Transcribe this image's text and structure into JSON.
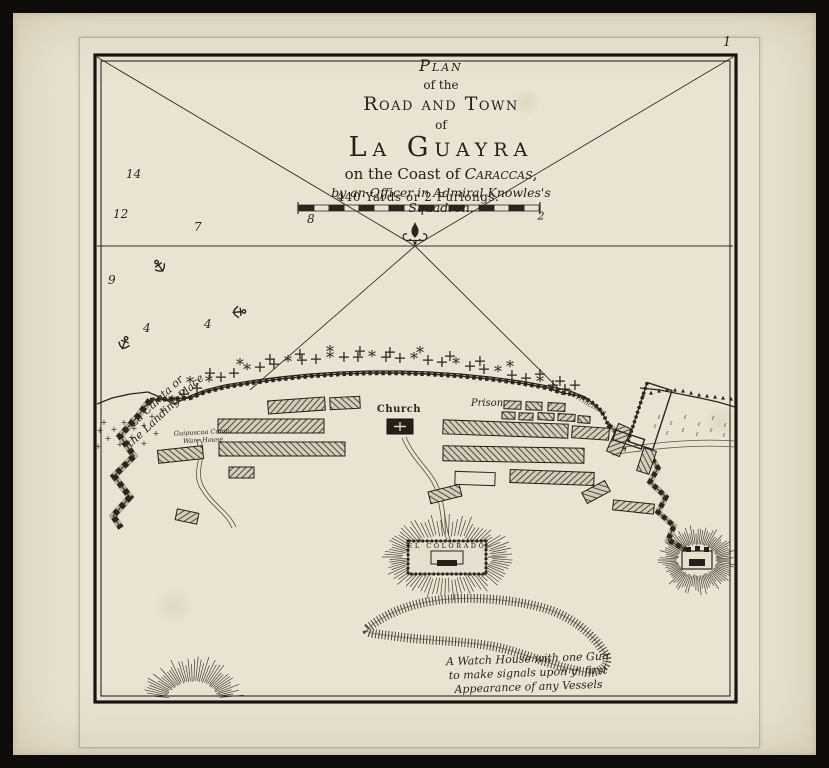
{
  "plate": {
    "number": "1"
  },
  "title": {
    "plan": "Plan",
    "of_the": "of the",
    "road_and_town": "Road and Town",
    "of": "of",
    "la_guayra": "La Guayra",
    "coast_pre": "on the Coast of ",
    "coast_name": "Caraccas",
    "coast_post": ",",
    "byline": "by an Officer in Admiral Knowles's Squadron."
  },
  "scale": {
    "label": "440 Yards or 2 Furlongs.",
    "right_mark": "2"
  },
  "labels": {
    "landing_place": "La Caleta or\nthe Landing Place",
    "warehouse": "Guipuscoa Comp.\nWare House",
    "church": "Church",
    "prison": "Prison",
    "trench": "la Trinchera",
    "fort": "EL COLORADO",
    "watch_house": "A Watch House with one Gun\nto make signals upon yᵉ first\nAppearance of any Vessels"
  },
  "colors": {
    "paper": "#e8e3d2",
    "ink": "#2b261d",
    "ink_light": "#4a4437",
    "wall_fill": "#b5ae9a",
    "border": "#141210"
  },
  "soundings": [
    {
      "v": "14",
      "x": 126,
      "y": 178
    },
    {
      "v": "12",
      "x": 113,
      "y": 218
    },
    {
      "v": "7",
      "x": 194,
      "y": 231
    },
    {
      "v": "8",
      "x": 307,
      "y": 223
    },
    {
      "v": "9",
      "x": 108,
      "y": 284
    },
    {
      "v": "4",
      "x": 143,
      "y": 332
    },
    {
      "v": "4",
      "x": 204,
      "y": 328
    }
  ],
  "anchors": [
    {
      "x": 160,
      "y": 267,
      "rot": -35
    },
    {
      "x": 238,
      "y": 312,
      "rot": 85
    },
    {
      "x": 124,
      "y": 344,
      "rot": 20
    }
  ],
  "map_data": {
    "frame_outer": [
      95,
      55,
      641,
      647
    ],
    "frame_inner": [
      101,
      61,
      629,
      635
    ],
    "compass_center": [
      415,
      246
    ],
    "bearing_lines": [
      [
        415,
        246,
        97,
        57
      ],
      [
        415,
        246,
        733,
        57
      ],
      [
        97,
        246,
        733,
        246
      ],
      [
        415,
        246,
        250,
        390
      ],
      [
        415,
        246,
        560,
        390
      ]
    ],
    "scale_bar": {
      "x": 299,
      "y": 205,
      "w": 240,
      "h": 6,
      "segments": 16
    },
    "shore_west": "97,404 112,398 130,394 148,392 162,398 174,404 190,396 205,390 225,385 250,381 280,377 310,374 340,372 370,371 400,371 430,372 460,374 490,377 520,381 548,386 570,391 585,397 596,406 604,416",
    "sea_wall": "150,400 190,398 205,392 225,387 250,383 280,379 310,376 340,374 370,373 400,373 430,374 460,376 490,379 520,383 548,388 563,393",
    "trench_arc": "M563,393 Q590,396 601,411 Q606,419 608,425",
    "west_wall": "150,400 138,416 120,436 134,456 114,476 130,497 113,516 121,528",
    "east_wall": "608,425 618,433 612,445 626,449",
    "east_wall2": "648,452 658,468 650,482 666,497 658,512 674,526 668,540 686,550",
    "east_coast": "640,388 660,390 680,394 700,398 718,402 735,407",
    "roads": [
      "M402,438 C412,462 430,472 436,492 C442,512 440,524 447,540",
      "M406,437 C416,461 434,471 440,491 C446,511 444,523 450,539",
      "M196,440 C205,458 190,470 200,488 C210,506 225,512 232,528",
      "M200,439 C209,457 194,469 204,487 C214,505 229,511 236,527",
      "M612,449 C650,443 695,438 735,441",
      "M612,455 C650,449 695,444 735,447"
    ],
    "buildings": [
      [
        268,
        399,
        57,
        13,
        -4
      ],
      [
        330,
        397,
        30,
        12,
        -3
      ],
      [
        218,
        419,
        106,
        14,
        0
      ],
      [
        219,
        442,
        126,
        14,
        0
      ],
      [
        229,
        467,
        25,
        11,
        0
      ],
      [
        158,
        448,
        45,
        13,
        -6
      ],
      [
        176,
        511,
        22,
        11,
        12
      ],
      [
        443,
        422,
        125,
        14,
        2
      ],
      [
        572,
        427,
        37,
        12,
        4
      ],
      [
        443,
        447,
        141,
        15,
        1
      ],
      [
        510,
        471,
        84,
        13,
        2
      ],
      [
        583,
        486,
        26,
        12,
        -28
      ],
      [
        613,
        502,
        41,
        10,
        6
      ],
      [
        429,
        488,
        32,
        12,
        -14
      ],
      [
        504,
        401,
        17,
        8,
        2
      ],
      [
        526,
        402,
        16,
        8,
        2
      ],
      [
        548,
        403,
        17,
        8,
        3
      ],
      [
        502,
        412,
        13,
        7,
        2
      ],
      [
        519,
        413,
        14,
        7,
        2
      ],
      [
        538,
        413,
        16,
        7,
        3
      ],
      [
        558,
        414,
        17,
        7,
        3
      ],
      [
        578,
        416,
        12,
        7,
        4
      ],
      [
        612,
        425,
        14,
        30,
        24
      ],
      [
        640,
        449,
        13,
        24,
        18
      ]
    ],
    "outline_blocks": [
      [
        455,
        472,
        40,
        13,
        2
      ]
    ],
    "church_block": {
      "x": 387,
      "y": 419,
      "w": 26,
      "h": 15
    },
    "compound_east": {
      "cx": 650,
      "cy": 416,
      "rect": [
        637,
        385,
        26,
        62
      ],
      "arm": [
        622,
        440,
        30,
        10
      ],
      "rot": 18
    },
    "forts": {
      "colorado": {
        "cx": 447,
        "cy": 557,
        "rx": 44,
        "ry": 22,
        "ray": 17,
        "rect": [
          408,
          541,
          78,
          33
        ],
        "inner_rect": [
          431,
          551,
          32,
          13
        ],
        "core": [
          437,
          560,
          20,
          6
        ]
      },
      "east": {
        "cx": 697,
        "cy": 560,
        "rx": 20,
        "ry": 16,
        "ray": 15,
        "rect": [
          682,
          551,
          30,
          18
        ],
        "inner_rect": [
          689,
          559,
          16,
          7
        ],
        "teeth": [
          [
            686,
            547
          ],
          [
            695,
            546
          ],
          [
            704,
            547
          ]
        ]
      }
    },
    "hill_sw": {
      "cx": 193,
      "cy": 699,
      "rx": 26,
      "ry": 18,
      "ray": 20,
      "a0": 185,
      "a1": 355
    },
    "ridge": "M368,628 C390,610 420,601 450,599 C480,597 520,600 550,610 C575,619 595,636 606,655 C610,666 600,674 585,672 C560,668 530,656 505,649 C475,641 430,641 400,637 C380,634 362,634 368,628 Z",
    "trees_plus": [
      [
        104,
        425
      ],
      [
        114,
        432
      ],
      [
        124,
        425
      ],
      [
        134,
        431
      ],
      [
        108,
        441
      ],
      [
        120,
        447
      ],
      [
        132,
        440
      ],
      [
        144,
        446
      ],
      [
        100,
        433
      ],
      [
        144,
        428
      ],
      [
        156,
        436
      ],
      [
        98,
        449
      ],
      [
        152,
        419
      ],
      [
        163,
        413
      ]
    ],
    "trees_band": [
      [
        172,
        407
      ],
      [
        184,
        399
      ],
      [
        197,
        393
      ],
      [
        209,
        387
      ],
      [
        221,
        382
      ],
      [
        234,
        378
      ],
      [
        247,
        375
      ],
      [
        260,
        372
      ],
      [
        274,
        369
      ],
      [
        288,
        367
      ],
      [
        302,
        365
      ],
      [
        316,
        364
      ],
      [
        330,
        363
      ],
      [
        344,
        362
      ],
      [
        358,
        362
      ],
      [
        372,
        362
      ],
      [
        386,
        362
      ],
      [
        400,
        363
      ],
      [
        414,
        364
      ],
      [
        428,
        365
      ],
      [
        442,
        367
      ],
      [
        456,
        369
      ],
      [
        470,
        371
      ],
      [
        484,
        374
      ],
      [
        498,
        377
      ],
      [
        512,
        380
      ],
      [
        526,
        383
      ],
      [
        540,
        387
      ],
      [
        553,
        390
      ],
      [
        565,
        394
      ],
      [
        240,
        370
      ],
      [
        270,
        364
      ],
      [
        300,
        359
      ],
      [
        330,
        357
      ],
      [
        360,
        356
      ],
      [
        390,
        357
      ],
      [
        420,
        358
      ],
      [
        450,
        361
      ],
      [
        480,
        366
      ],
      [
        510,
        372
      ],
      [
        540,
        379
      ],
      [
        210,
        378
      ],
      [
        190,
        388
      ],
      [
        560,
        386
      ],
      [
        575,
        390
      ]
    ],
    "trees_east": [
      [
        643,
        396
      ],
      [
        651,
        394
      ],
      [
        659,
        392
      ],
      [
        667,
        391
      ],
      [
        675,
        391
      ],
      [
        683,
        392
      ],
      [
        691,
        394
      ],
      [
        699,
        396
      ],
      [
        707,
        397
      ],
      [
        715,
        398
      ],
      [
        723,
        399
      ],
      [
        731,
        400
      ]
    ],
    "grass_east": [
      [
        659,
        419
      ],
      [
        671,
        425
      ],
      [
        685,
        419
      ],
      [
        699,
        426
      ],
      [
        713,
        420
      ],
      [
        725,
        427
      ],
      [
        667,
        435
      ],
      [
        683,
        432
      ],
      [
        697,
        436
      ],
      [
        711,
        432
      ],
      [
        724,
        437
      ],
      [
        655,
        428
      ]
    ]
  }
}
